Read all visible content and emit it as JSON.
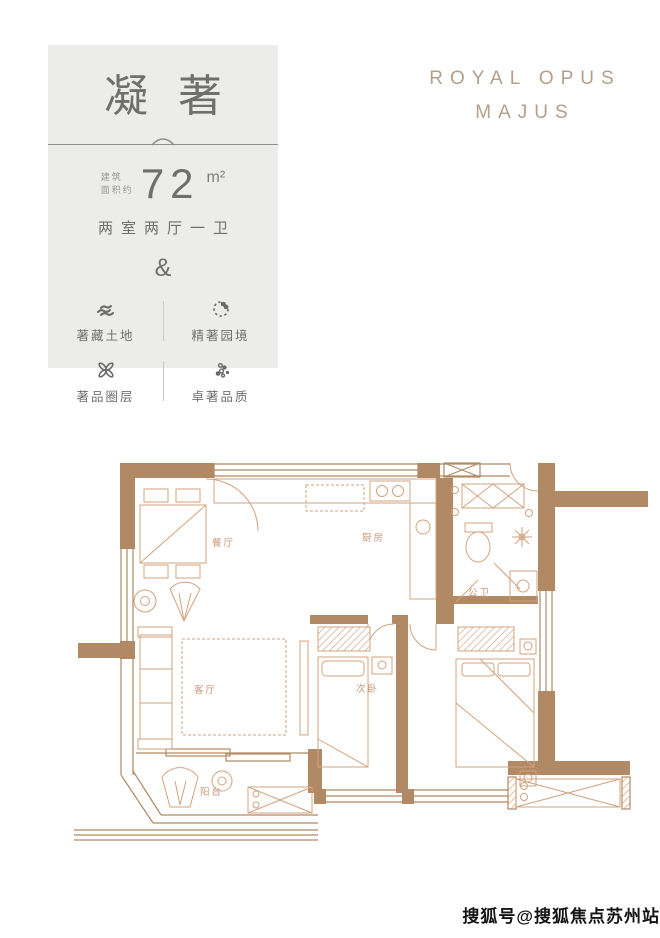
{
  "card": {
    "title": "凝著",
    "area_prefix_line1": "建筑",
    "area_prefix_line2": "面积约",
    "area_value": "72",
    "area_unit": "m²",
    "layout_text": "两室两厅一卫",
    "ampersand": "&",
    "features": [
      {
        "icon": "terraced-land-icon",
        "label": "著藏土地"
      },
      {
        "icon": "enso-garden-icon",
        "label": "精著园境"
      },
      {
        "icon": "circle-knot-icon",
        "label": "著品圈层"
      },
      {
        "icon": "dots-cluster-icon",
        "label": "卓著品质"
      }
    ]
  },
  "brand": {
    "line1": "ROYAL OPUS",
    "line2": "MAJUS"
  },
  "floorplan": {
    "rooms": [
      {
        "name": "dining-room",
        "label": "餐厅"
      },
      {
        "name": "kitchen",
        "label": "厨房"
      },
      {
        "name": "public-bathroom",
        "label": "公卫"
      },
      {
        "name": "living-room",
        "label": "客厅"
      },
      {
        "name": "second-bedroom",
        "label": "次卧"
      },
      {
        "name": "balcony",
        "label": "阳台"
      }
    ],
    "colors": {
      "wall": "#b18a65",
      "furniture": "#d2a37f",
      "label": "#c9967a"
    }
  },
  "watermark": {
    "text": "搜狐号@搜狐焦点苏州站"
  }
}
